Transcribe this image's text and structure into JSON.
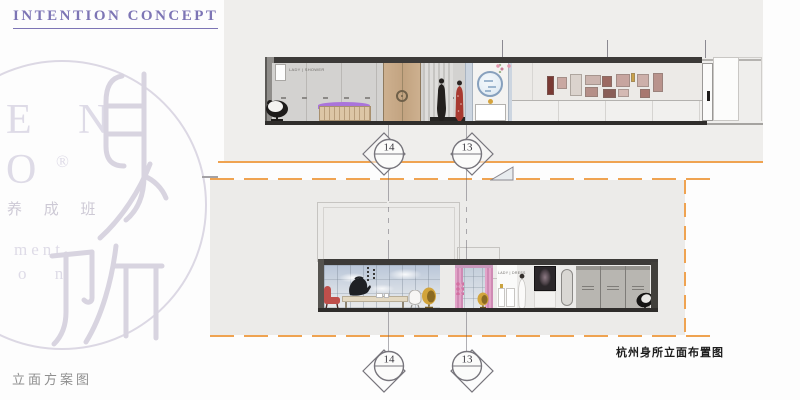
{
  "page": {
    "title": "INTENTION CONCEPT",
    "footer_label": "立面方案图",
    "caption": "杭州身所立面布置图"
  },
  "colors": {
    "accent_orange": "#EFA351",
    "title_purple": "#7D75B5",
    "watermark_lavender": "#DCD8E4",
    "panel_gray": "#EDECEA",
    "drawing_dark": "#2F2D2B"
  },
  "watermark": {
    "line1": "E N",
    "line2": "O",
    "registered": "®",
    "line3": "养 成 班",
    "line4": "ment",
    "line5": "o n",
    "brand_glyphs": "身所"
  },
  "grid_markers": {
    "left": "14",
    "right": "13"
  },
  "elevations": {
    "upper": {
      "room_label": "LADY | SHOWER"
    },
    "lower": {
      "room_label": "LADY | DRESS"
    }
  }
}
